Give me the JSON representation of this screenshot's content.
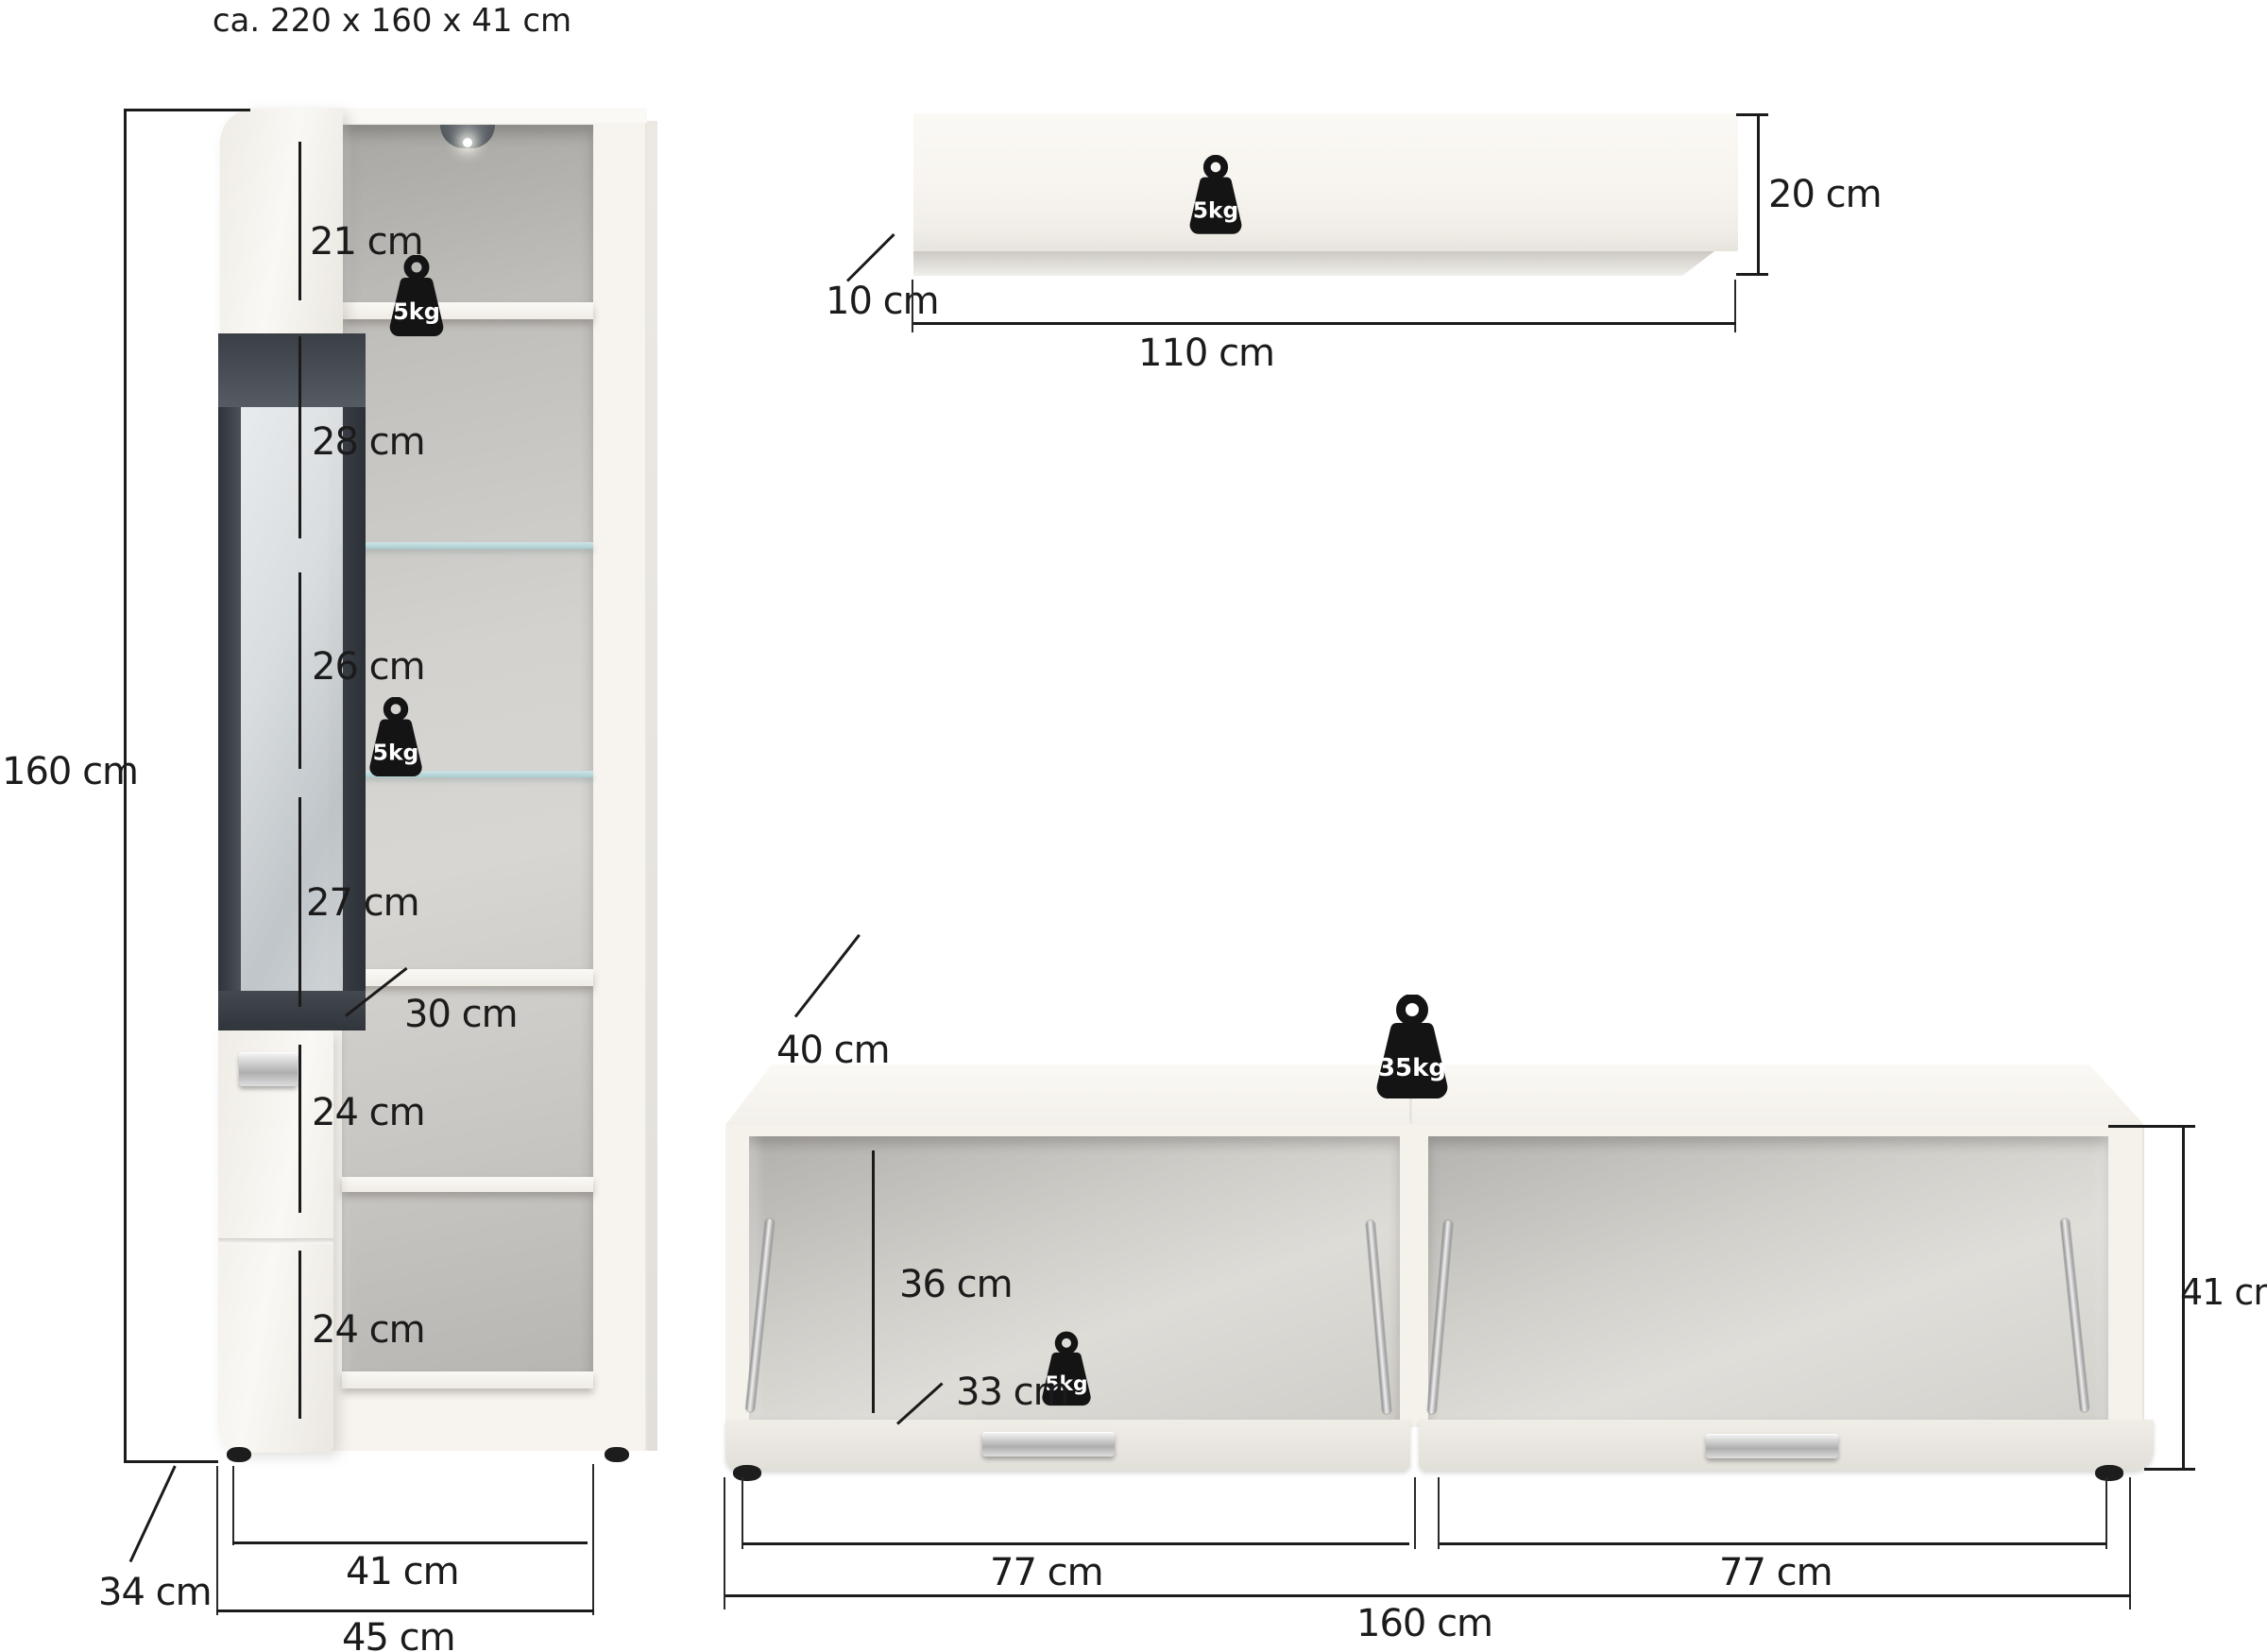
{
  "title": "ca. 220 x 160 x 41 cm",
  "colors": {
    "line": "#1b1b1b",
    "furniture_white": "#f7f4ef",
    "interior_gray": "#c6c4c0",
    "glass_frame": "#3f444b",
    "glass_shelf": "#b5d4d7",
    "weight_black": "#141414"
  },
  "cabinet": {
    "weight_top": "5kg",
    "weight_middle": "5kg",
    "dims": {
      "height": "160 cm",
      "top_compartment": "21 cm",
      "glass_1": "28 cm",
      "glass_2": "26 cm",
      "glass_3": "27 cm",
      "shelf_depth": "30 cm",
      "door_1": "24 cm",
      "door_2": "24 cm",
      "depth": "34 cm",
      "body_width": "41 cm",
      "total_width": "45 cm"
    }
  },
  "wall_shelf": {
    "weight": "5kg",
    "dims": {
      "height": "20 cm",
      "depth": "10 cm",
      "width": "110 cm"
    }
  },
  "lowboard": {
    "weight_top": "35kg",
    "weight_inside": "5kg",
    "dims": {
      "depth": "40 cm",
      "inner_height": "36 cm",
      "flap_depth": "33 cm",
      "height": "41 cm",
      "left_width": "77 cm",
      "right_width": "77 cm",
      "total_width": "160 cm"
    }
  }
}
